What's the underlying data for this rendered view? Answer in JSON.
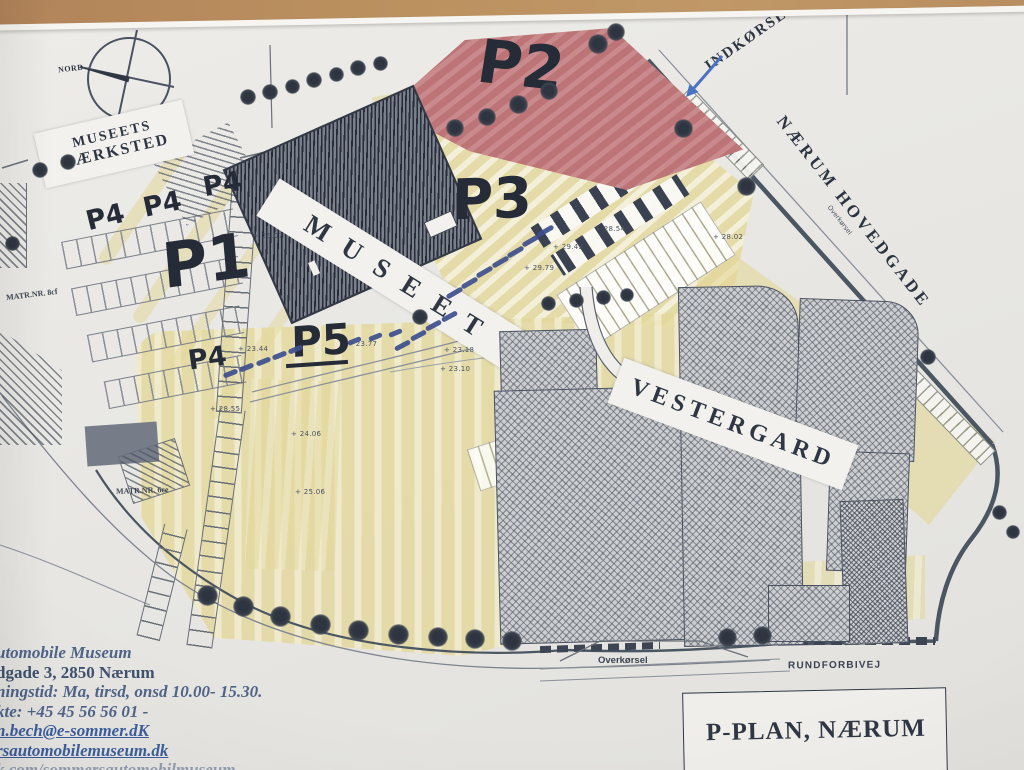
{
  "surface": {
    "type": "wooden desk under photographed paper plan"
  },
  "map": {
    "compass": {
      "label": "NORD"
    },
    "labels": {
      "vaerksted_line1": "MUSEETS",
      "vaerksted_line2": "VÆRKSTED",
      "museet": "MUSEET",
      "vestergard": "VESTERGARD",
      "naerum_hovedgade": "NÆRUM HOVEDGADE",
      "indkoersel": "INDKØRSEL",
      "rundforbivej": "RUNDFORBIVEJ",
      "overkoersel_bottom": "Overkørsel",
      "overkoersel_road": "Overkørsel",
      "matr_nr_1": "MATR.NR. 8cf",
      "matr_nr_2": "MATR.NR. 6ce"
    },
    "handwritten": {
      "p1": "P1",
      "p2": "P2",
      "p3": "P3",
      "p5": "P5",
      "p4_labels": [
        "P4",
        "P4",
        "P4",
        "P4"
      ]
    },
    "elevations": [
      "+ 25.07",
      "+ 28.54",
      "+ 29.43",
      "+ 28.02",
      "+ 29.79",
      "+ 23.77",
      "+ 23.44",
      "+ 28.55",
      "+ 23.18",
      "+ 23.10",
      "+ 24.06",
      "+ 25.06"
    ],
    "title_box": {
      "title": "P-PLAN, NÆRUM"
    },
    "colors": {
      "p2_fill": "#bd7476",
      "ground_yellow": "#e3d79a",
      "pen_blue": "#3d4f8e",
      "ink": "#2f3744"
    }
  },
  "info_block": {
    "lines": [
      "utomobile Museum",
      "dgade 3, 2850 Nærum",
      "ningstid: Ma, tirsd, onsd 10.00- 15.30.",
      "kte: +45 45 56 56 01 -",
      "n.bech@e-sommer.dK",
      "rsautomobilemuseum.dk",
      "k.com/sommersautomobilmuseum"
    ]
  }
}
